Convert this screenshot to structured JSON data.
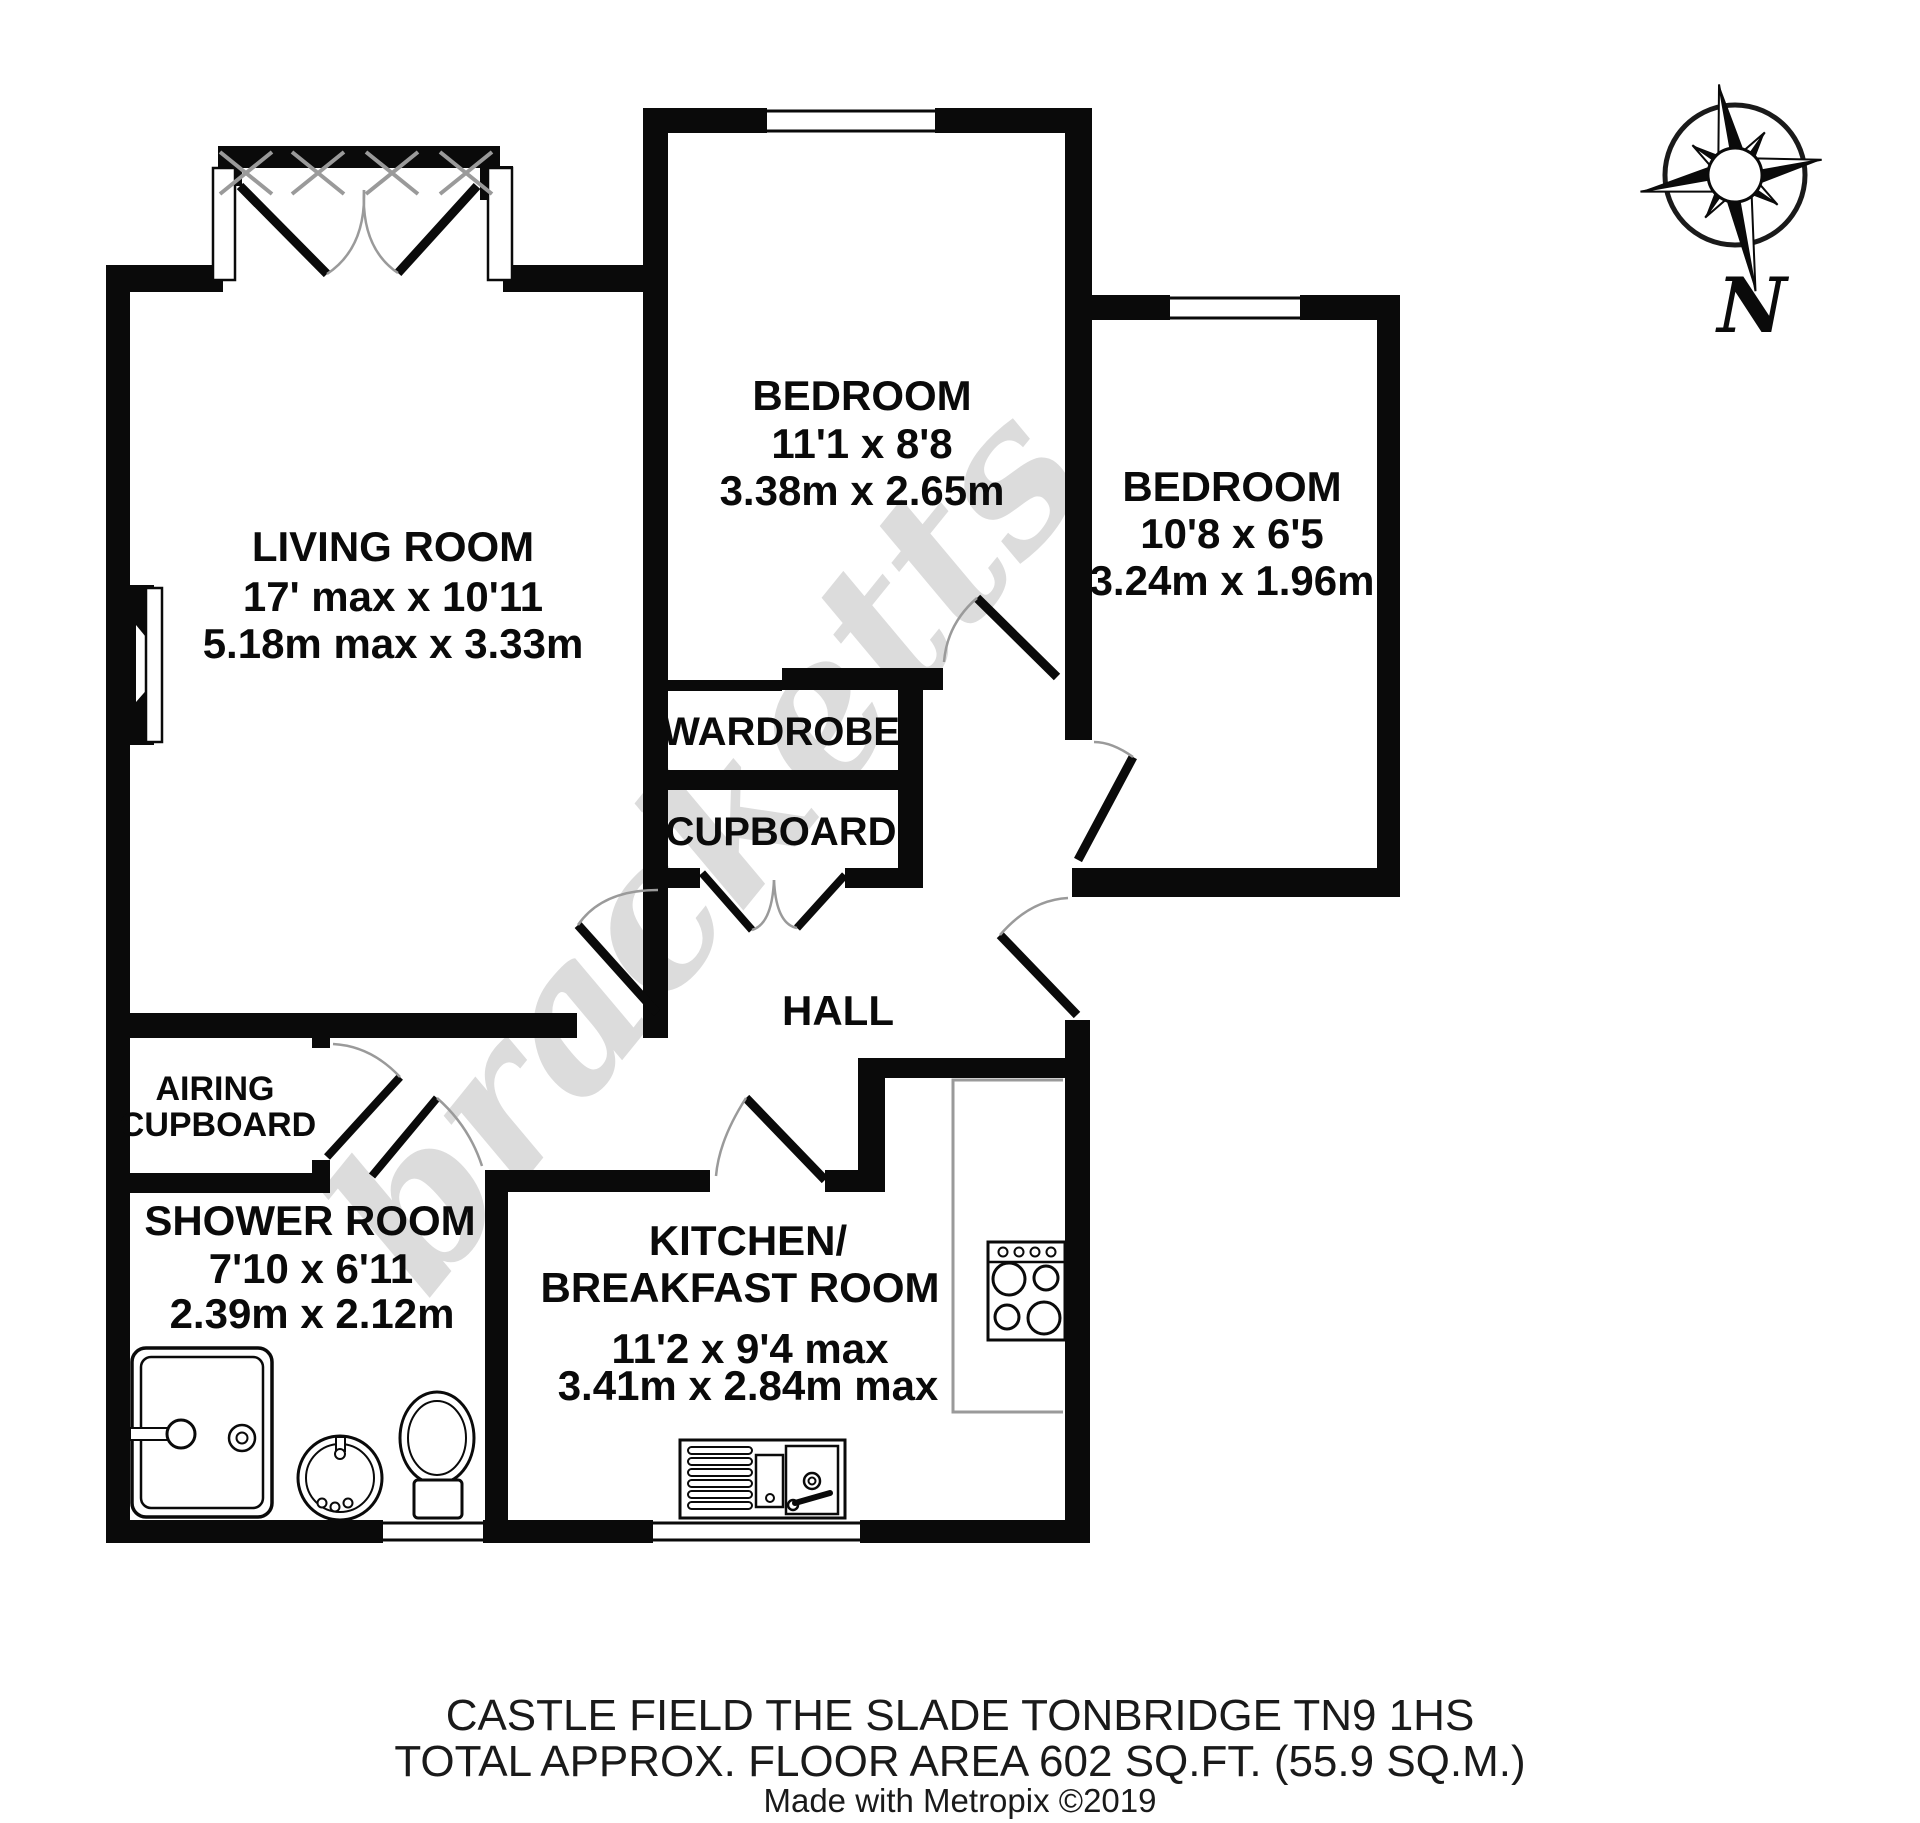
{
  "watermark": "bracketts",
  "compass": {
    "label": "N"
  },
  "rooms": {
    "living_room": {
      "name": "LIVING ROOM",
      "imperial": "17' max x 10'11",
      "metric": "5.18m max x 3.33m"
    },
    "bedroom1": {
      "name": "BEDROOM",
      "imperial": "11'1 x 8'8",
      "metric": "3.38m x 2.65m"
    },
    "bedroom2": {
      "name": "BEDROOM",
      "imperial": "10'8 x 6'5",
      "metric": "3.24m x 1.96m"
    },
    "wardrobe": {
      "name": "WARDROBE"
    },
    "cupboard": {
      "name": "CUPBOARD"
    },
    "hall": {
      "name": "HALL"
    },
    "airing_cupboard": {
      "line1": "AIRING",
      "line2": "CUPBOARD"
    },
    "shower_room": {
      "name": "SHOWER ROOM",
      "imperial": "7'10 x 6'11",
      "metric": "2.39m x 2.12m"
    },
    "kitchen": {
      "line1": "KITCHEN/",
      "line2": "BREAKFAST ROOM",
      "imperial": "11'2 x 9'4 max",
      "metric": "3.41m x 2.84m max"
    }
  },
  "footer": {
    "address": "CASTLE FIELD THE SLADE TONBRIDGE TN9 1HS",
    "area": "TOTAL APPROX. FLOOR AREA 602 SQ.FT. (55.9 SQ.M.)",
    "credit": "Made with Metropix ©2019"
  },
  "colors": {
    "wall": "#0a0a0a",
    "arc": "#9a9a9a",
    "watermark": "#dcdcdc"
  }
}
